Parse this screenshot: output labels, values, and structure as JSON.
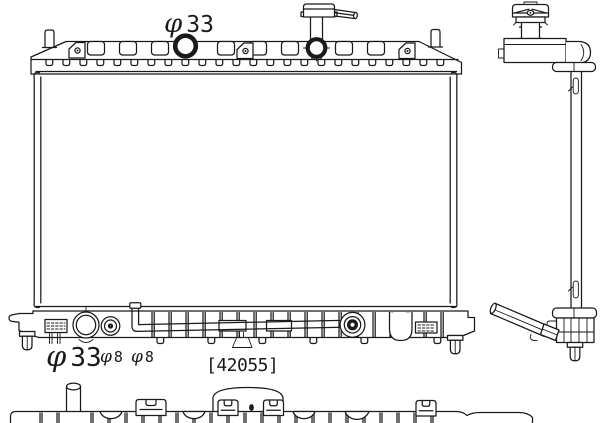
{
  "drawing": {
    "part_number_label": "[42055]",
    "labels": {
      "top_inlet": {
        "symbol": "φ",
        "value": "33"
      },
      "bottom_outlet": {
        "symbol": "φ",
        "value": "33"
      },
      "bottom_fitting_a": {
        "symbol": "φ",
        "value": "8"
      },
      "bottom_fitting_b": {
        "symbol": "φ",
        "value": "8"
      }
    },
    "colors": {
      "line": "#1a1a1a",
      "background": "#ffffff"
    }
  }
}
